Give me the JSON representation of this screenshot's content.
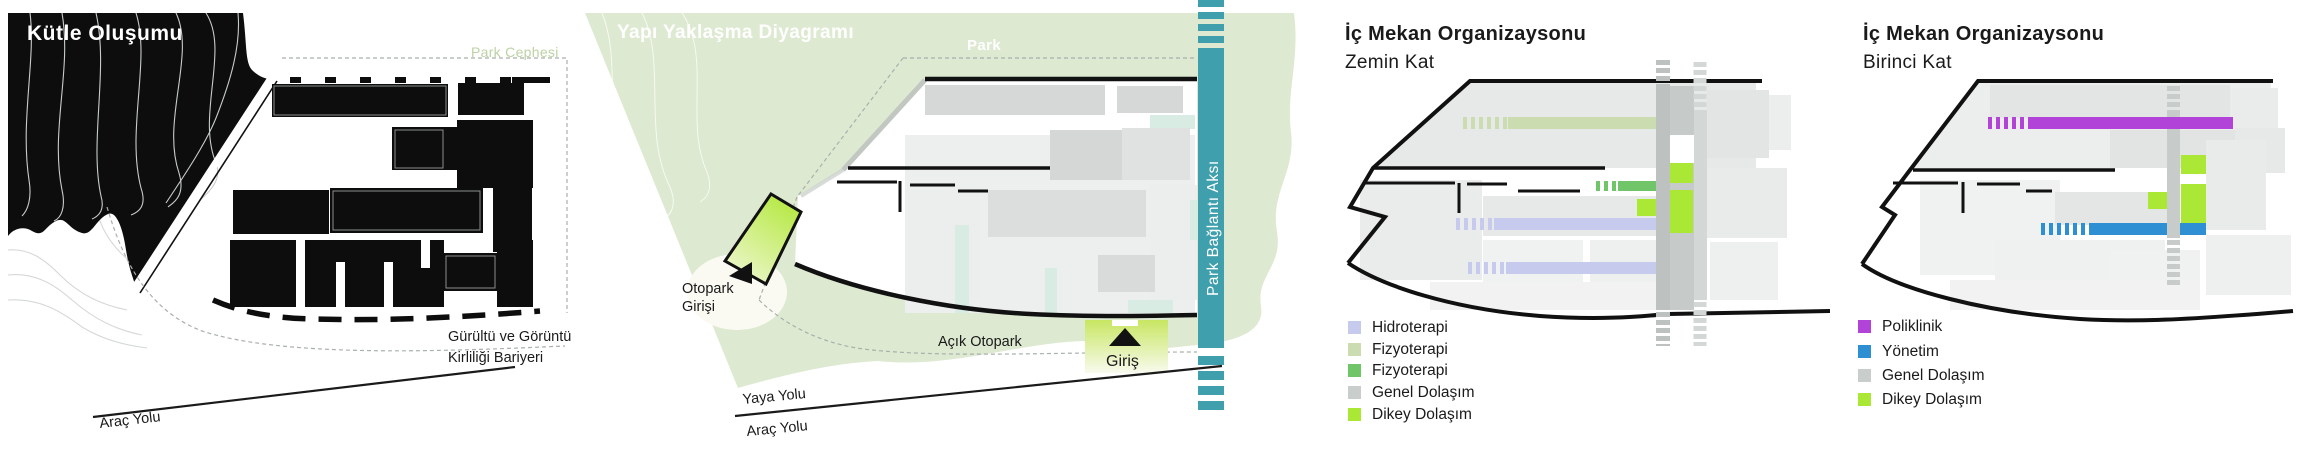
{
  "panel1": {
    "title": "Kütle Oluşumu",
    "park_cephesi": "Park Cephesi",
    "barrier_line1": "Gürültü ve Görüntü",
    "barrier_line2": "Kirliliği Bariyeri",
    "arac_yolu": "Araç Yolu"
  },
  "panel2": {
    "title": "Yapı Yaklaşma Diyagramı",
    "park": "Park",
    "park_baglanti_aksi": "Park Bağlantı Aksı",
    "otopark_line1": "Otopark",
    "otopark_line2": "Girişi",
    "acik_otopark": "Açık Otopark",
    "giris": "Giriş",
    "yaya_yolu": "Yaya Yolu",
    "arac_yolu": "Araç Yolu"
  },
  "panel3": {
    "title": "İç Mekan Organizaysonu",
    "subtitle": "Zemin Kat",
    "legend": [
      {
        "label": "Hidroterapi",
        "color": "#c6cbee"
      },
      {
        "label": "Fizyoterapi",
        "color": "#cbdcb0"
      },
      {
        "label": "Fizyoterapi",
        "color": "#6fc568"
      },
      {
        "label": "Genel Dolaşım",
        "color": "#c9cecd"
      },
      {
        "label": "Dikey Dolaşım",
        "color": "#abe836"
      }
    ]
  },
  "panel4": {
    "title": "İç Mekan Organizaysonu",
    "subtitle": "Birinci Kat",
    "legend": [
      {
        "label": "Poliklinik",
        "color": "#b243d9"
      },
      {
        "label": "Yönetim",
        "color": "#2e8fd2"
      },
      {
        "label": "Genel Dolaşım",
        "color": "#c9cecd"
      },
      {
        "label": "Dikey Dolaşım",
        "color": "#abe836"
      }
    ]
  },
  "colors": {
    "ink": "#111111",
    "teal": "#3f9fac",
    "park_green": "#dde9d0",
    "sage_text": "#bdd2a4",
    "mint": "#d9ece3",
    "lavender": "#c6cbee",
    "fizyo_light": "#cbdcb0",
    "fizyo_green": "#6fc568",
    "dikey": "#abe836",
    "poliklinik": "#b243d9",
    "yonetim": "#2e8fd2",
    "genel": "#c9cecd",
    "band_grey": "#bdc2c1",
    "band_grey_light": "#d3d7d6",
    "dash_grey": "#a9b0ac"
  }
}
